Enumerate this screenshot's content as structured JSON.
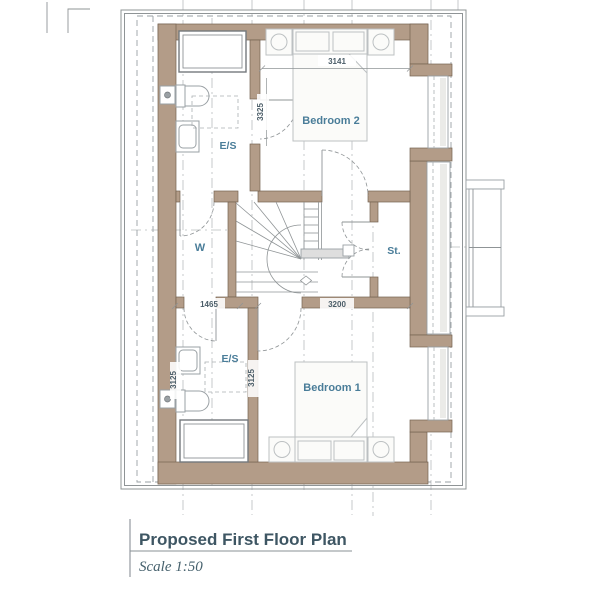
{
  "title": {
    "name": "Proposed First Floor Plan",
    "scale": "Scale 1:50"
  },
  "rooms": {
    "bedroom2": "Bedroom 2",
    "bedroom1": "Bedroom 1",
    "ensuite2": "E/S",
    "ensuite1": "E/S",
    "wardrobe": "W",
    "store": "St."
  },
  "dims": {
    "bedroom2_width": "3141",
    "bedroom2_depth": "3325",
    "hall": "1465",
    "bedroom1_width": "3200",
    "bedroom1_depth": "3125",
    "ensuite1_depth": "3125"
  },
  "colors": {
    "wall_fill": "#b39c88",
    "wall_edge": "#756352",
    "line_gray": "#8f9496",
    "room_label": "#4a7d99",
    "dimension_text": "#4b5d68",
    "title_text": "#3e5663"
  }
}
